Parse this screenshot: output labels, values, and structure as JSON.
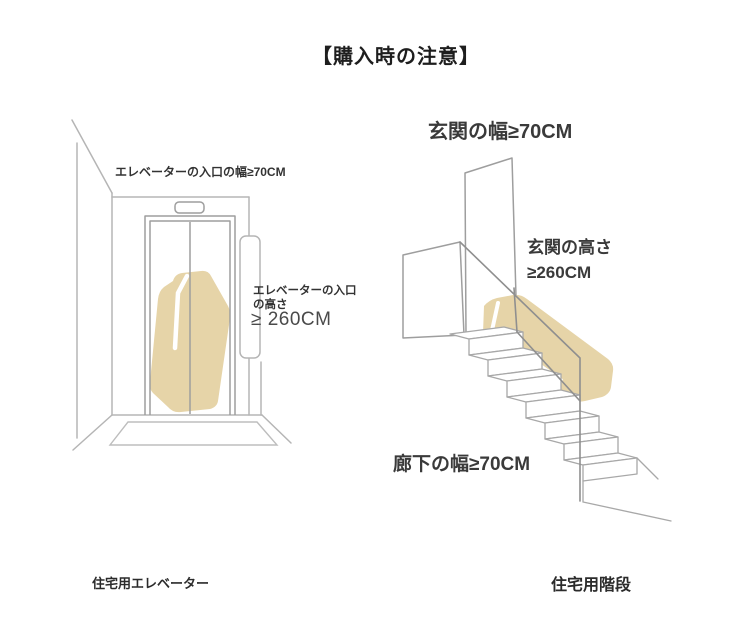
{
  "title": "【購入時の注意】",
  "elevator": {
    "entrance_width_label": "エレベーターの入口の幅≥70CM",
    "entrance_height_label": "エレベーターの入口\nの高さ",
    "entrance_height_value": "≥ 260CM",
    "caption": "住宅用エレベーター"
  },
  "stairs": {
    "entrance_width_label": "玄関の幅≥70CM",
    "entrance_height_label": "玄関の高さ\n≥260CM",
    "corridor_width_label": "廊下の幅≥70CM",
    "caption": "住宅用階段"
  },
  "colors": {
    "furniture_beige": "#e6d4a8",
    "line_gray": "#b5b5b5",
    "text_dark": "#2b2b2b"
  }
}
